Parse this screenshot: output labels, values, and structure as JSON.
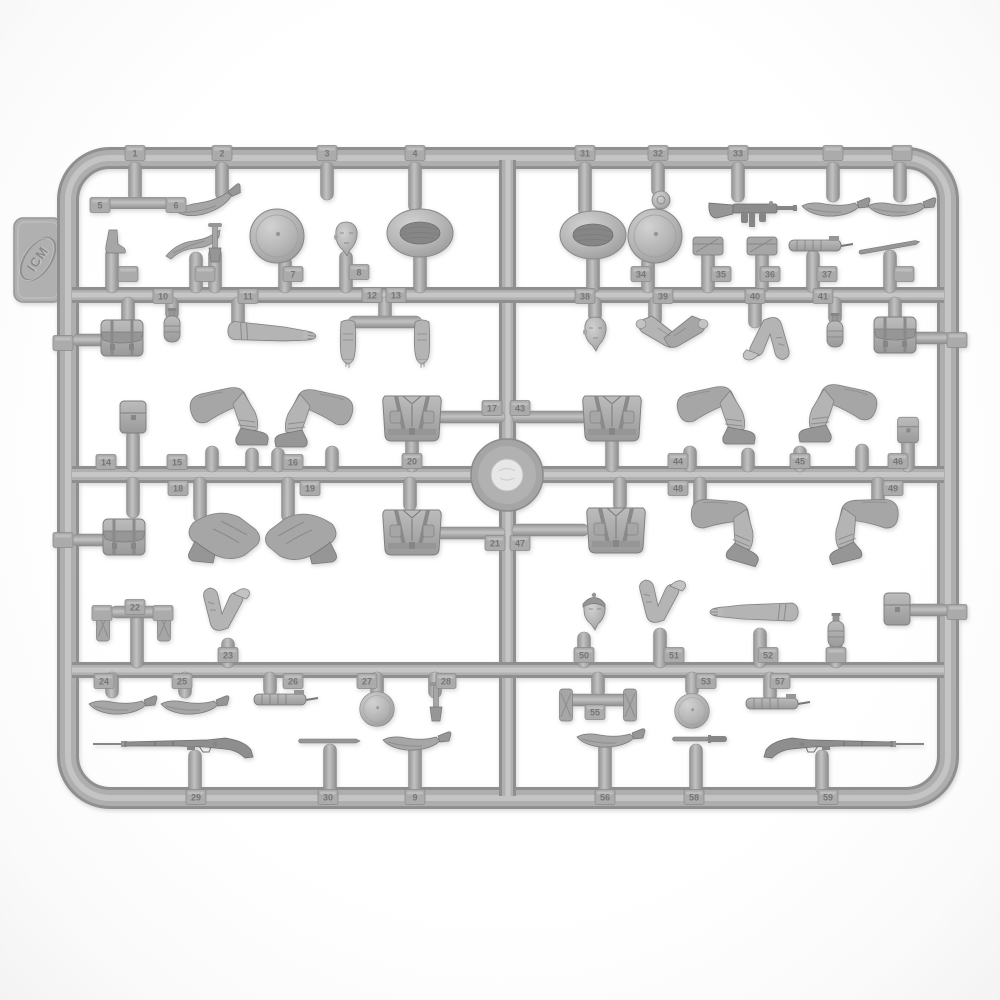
{
  "meta": {
    "subject": "grey injection-molded styrene model-kit sprue (parts tree) with WWI infantry figure parts photographed on white background",
    "background_color": "#fdfdfd"
  },
  "sprue": {
    "logo_text": "ICM",
    "colors": {
      "plastic_base": "#b0b0b0",
      "plastic_shadow": "#8e8e8e",
      "plastic_highlight": "#c8c8c8",
      "weapon_grey": "#8d8d8d",
      "boss_inner": "#e7e7e7"
    },
    "center_boss": {
      "x": 507,
      "y": 475
    },
    "parts": [
      {
        "s": "hbar",
        "x": 138,
        "y": 203
      },
      {
        "s": "kukri",
        "x": 208,
        "y": 200,
        "r": -18
      },
      {
        "s": "boot",
        "x": 112,
        "y": 242
      },
      {
        "s": "sidecap",
        "x": 193,
        "y": 247
      },
      {
        "s": "etool",
        "x": 215,
        "y": 242
      },
      {
        "s": "helmet",
        "x": 277,
        "y": 236
      },
      {
        "s": "head",
        "x": 346,
        "y": 237
      },
      {
        "s": "pilotka",
        "x": 420,
        "y": 233
      },
      {
        "s": "backpack",
        "x": 122,
        "y": 338
      },
      {
        "s": "canteen",
        "x": 172,
        "y": 328
      },
      {
        "s": "armstraight",
        "x": 270,
        "y": 333,
        "r": 4
      },
      {
        "s": "hbar",
        "x": 385,
        "y": 322
      },
      {
        "s": "armdown",
        "x": 348,
        "y": 342
      },
      {
        "s": "armdown",
        "x": 422,
        "y": 342,
        "fx": 1
      },
      {
        "s": "pouchsq",
        "x": 133,
        "y": 417
      },
      {
        "s": "legbent",
        "x": 235,
        "y": 414
      },
      {
        "s": "legbent",
        "x": 308,
        "y": 416,
        "fx": 1
      },
      {
        "s": "torso",
        "x": 412,
        "y": 417
      },
      {
        "s": "backpack",
        "x": 124,
        "y": 537
      },
      {
        "s": "legslow",
        "x": 225,
        "y": 537
      },
      {
        "s": "legslow",
        "x": 300,
        "y": 538,
        "fx": 1
      },
      {
        "s": "torso",
        "x": 412,
        "y": 531
      },
      {
        "s": "flat",
        "x": 103,
        "y": 625
      },
      {
        "s": "flat",
        "x": 164,
        "y": 625
      },
      {
        "s": "armbent",
        "x": 224,
        "y": 616
      },
      {
        "s": "kukri",
        "x": 122,
        "y": 702
      },
      {
        "s": "kukri",
        "x": 194,
        "y": 702
      },
      {
        "s": "mgpart",
        "x": 280,
        "y": 700
      },
      {
        "s": "helmet",
        "x": 377,
        "y": 709,
        "sc": 0.64
      },
      {
        "s": "etool",
        "x": 436,
        "y": 701
      },
      {
        "s": "rifle",
        "x": 185,
        "y": 744
      },
      {
        "s": "stick",
        "x": 330,
        "y": 741
      },
      {
        "s": "kukri",
        "x": 416,
        "y": 738
      },
      {
        "s": "pilotka",
        "x": 593,
        "y": 235
      },
      {
        "s": "disc",
        "x": 661,
        "y": 200
      },
      {
        "s": "helmet",
        "x": 655,
        "y": 236
      },
      {
        "s": "smg",
        "x": 745,
        "y": 210
      },
      {
        "s": "pouchflat",
        "x": 708,
        "y": 246
      },
      {
        "s": "pouchflat",
        "x": 762,
        "y": 246
      },
      {
        "s": "mgpart",
        "x": 815,
        "y": 246
      },
      {
        "s": "stick",
        "x": 890,
        "y": 247,
        "r": -10
      },
      {
        "s": "kukri",
        "x": 835,
        "y": 204
      },
      {
        "s": "kukri",
        "x": 901,
        "y": 204
      },
      {
        "s": "head",
        "x": 595,
        "y": 332
      },
      {
        "s": "armspair",
        "x": 672,
        "y": 330
      },
      {
        "s": "armbent",
        "x": 768,
        "y": 332,
        "r": 178
      },
      {
        "s": "canteen",
        "x": 835,
        "y": 333
      },
      {
        "s": "backpack",
        "x": 895,
        "y": 335
      },
      {
        "s": "torso",
        "x": 612,
        "y": 417
      },
      {
        "s": "legbent",
        "x": 722,
        "y": 413
      },
      {
        "s": "legbent",
        "x": 832,
        "y": 411,
        "fx": 1
      },
      {
        "s": "pouchsq",
        "x": 908,
        "y": 430,
        "sc": 0.8
      },
      {
        "s": "torso",
        "x": 616,
        "y": 529
      },
      {
        "s": "legbent",
        "x": 733,
        "y": 528,
        "r": 16
      },
      {
        "s": "legbent",
        "x": 856,
        "y": 527,
        "fx": 1,
        "r": -14
      },
      {
        "s": "headcap",
        "x": 594,
        "y": 611
      },
      {
        "s": "armbent",
        "x": 660,
        "y": 608
      },
      {
        "s": "armstraight",
        "x": 756,
        "y": 612,
        "fx": 1
      },
      {
        "s": "canteen",
        "x": 836,
        "y": 633
      },
      {
        "s": "pouchsq",
        "x": 897,
        "y": 609
      },
      {
        "s": "flat",
        "x": 566,
        "y": 705
      },
      {
        "s": "flat",
        "x": 630,
        "y": 705
      },
      {
        "s": "helmet",
        "x": 692,
        "y": 711,
        "sc": 0.64
      },
      {
        "s": "mgpart",
        "x": 772,
        "y": 704
      },
      {
        "s": "kukri",
        "x": 610,
        "y": 735
      },
      {
        "s": "bayonet",
        "x": 700,
        "y": 739
      },
      {
        "s": "rifle",
        "x": 832,
        "y": 744,
        "fx": 1
      }
    ],
    "stems": [
      [
        135,
        166,
        198
      ],
      [
        222,
        166,
        196
      ],
      [
        327,
        166,
        196
      ],
      [
        415,
        166,
        208
      ],
      [
        112,
        252,
        289
      ],
      [
        196,
        256,
        289
      ],
      [
        215,
        252,
        289
      ],
      [
        285,
        260,
        289
      ],
      [
        346,
        255,
        289
      ],
      [
        420,
        255,
        289
      ],
      [
        128,
        301,
        322
      ],
      [
        172,
        301,
        316
      ],
      [
        238,
        301,
        324
      ],
      [
        385,
        301,
        320
      ],
      [
        133,
        434,
        468
      ],
      [
        212,
        450,
        468
      ],
      [
        252,
        452,
        468
      ],
      [
        278,
        452,
        468
      ],
      [
        332,
        450,
        468
      ],
      [
        412,
        438,
        468
      ],
      [
        133,
        481,
        514
      ],
      [
        200,
        481,
        518
      ],
      [
        288,
        481,
        518
      ],
      [
        410,
        481,
        507
      ],
      [
        137,
        616,
        664
      ],
      [
        228,
        642,
        664
      ],
      [
        112,
        676,
        694
      ],
      [
        185,
        676,
        694
      ],
      [
        270,
        676,
        692
      ],
      [
        377,
        676,
        694
      ],
      [
        435,
        676,
        694
      ],
      [
        195,
        754,
        790
      ],
      [
        330,
        748,
        790
      ],
      [
        415,
        746,
        790
      ],
      [
        585,
        166,
        212
      ],
      [
        658,
        166,
        192
      ],
      [
        738,
        166,
        198
      ],
      [
        833,
        166,
        198
      ],
      [
        900,
        166,
        198
      ],
      [
        593,
        258,
        289
      ],
      [
        648,
        260,
        289
      ],
      [
        708,
        254,
        289
      ],
      [
        762,
        254,
        289
      ],
      [
        813,
        254,
        289
      ],
      [
        890,
        254,
        289
      ],
      [
        595,
        301,
        318
      ],
      [
        655,
        301,
        322
      ],
      [
        755,
        301,
        324
      ],
      [
        835,
        301,
        320
      ],
      [
        895,
        301,
        318
      ],
      [
        612,
        438,
        468
      ],
      [
        690,
        450,
        468
      ],
      [
        748,
        452,
        468
      ],
      [
        800,
        450,
        468
      ],
      [
        862,
        448,
        468
      ],
      [
        908,
        441,
        468
      ],
      [
        620,
        481,
        507
      ],
      [
        700,
        481,
        512
      ],
      [
        878,
        481,
        512
      ],
      [
        584,
        636,
        664
      ],
      [
        660,
        632,
        664
      ],
      [
        760,
        632,
        664
      ],
      [
        836,
        646,
        664
      ],
      [
        598,
        676,
        694
      ],
      [
        692,
        676,
        692
      ],
      [
        770,
        676,
        698
      ],
      [
        605,
        744,
        790
      ],
      [
        696,
        748,
        790
      ],
      [
        822,
        754,
        790
      ]
    ],
    "hstems": [
      [
        76,
        104,
        340
      ],
      [
        76,
        108,
        540
      ],
      [
        352,
        418,
        322
      ],
      [
        436,
        501,
        417
      ],
      [
        436,
        501,
        533
      ],
      [
        114,
        162,
        612
      ],
      [
        516,
        585,
        417
      ],
      [
        516,
        585,
        530
      ],
      [
        908,
        946,
        338
      ],
      [
        910,
        946,
        610
      ],
      [
        570,
        628,
        700
      ]
    ],
    "tabs": [
      [
        "1",
        135,
        153
      ],
      [
        "2",
        222,
        153
      ],
      [
        "3",
        327,
        153
      ],
      [
        "4",
        415,
        153
      ],
      [
        "5",
        100,
        205
      ],
      [
        "6",
        176,
        205
      ],
      [
        "7",
        293,
        274
      ],
      [
        "8",
        359,
        272
      ],
      [
        "",
        128,
        274
      ],
      [
        "",
        205,
        274
      ],
      [
        "",
        63,
        343
      ],
      [
        "10",
        163,
        296
      ],
      [
        "11",
        248,
        296
      ],
      [
        "12",
        372,
        295
      ],
      [
        "13",
        396,
        295
      ],
      [
        "14",
        106,
        462
      ],
      [
        "15",
        177,
        462
      ],
      [
        "16",
        293,
        462
      ],
      [
        "17",
        492,
        408
      ],
      [
        "20",
        412,
        461
      ],
      [
        "18",
        178,
        488
      ],
      [
        "19",
        310,
        488
      ],
      [
        "",
        63,
        540
      ],
      [
        "21",
        495,
        543
      ],
      [
        "22",
        135,
        607
      ],
      [
        "23",
        228,
        655
      ],
      [
        "",
        102,
        613
      ],
      [
        "",
        163,
        613
      ],
      [
        "24",
        104,
        681
      ],
      [
        "25",
        182,
        681
      ],
      [
        "26",
        293,
        681
      ],
      [
        "27",
        367,
        681
      ],
      [
        "28",
        446,
        681
      ],
      [
        "29",
        196,
        797
      ],
      [
        "30",
        328,
        797
      ],
      [
        "9",
        415,
        797
      ],
      [
        "31",
        585,
        153
      ],
      [
        "32",
        658,
        153
      ],
      [
        "33",
        738,
        153
      ],
      [
        "",
        833,
        153
      ],
      [
        "",
        902,
        153
      ],
      [
        "34",
        641,
        274
      ],
      [
        "35",
        721,
        274
      ],
      [
        "36",
        770,
        274
      ],
      [
        "37",
        827,
        274
      ],
      [
        "",
        904,
        274
      ],
      [
        "38",
        585,
        296
      ],
      [
        "39",
        663,
        296
      ],
      [
        "40",
        755,
        296
      ],
      [
        "41",
        823,
        296
      ],
      [
        "",
        957,
        340
      ],
      [
        "43",
        520,
        408
      ],
      [
        "44",
        678,
        461
      ],
      [
        "45",
        800,
        461
      ],
      [
        "46",
        898,
        461
      ],
      [
        "47",
        520,
        543
      ],
      [
        "48",
        678,
        488
      ],
      [
        "49",
        893,
        488
      ],
      [
        "50",
        584,
        655
      ],
      [
        "51",
        674,
        655
      ],
      [
        "52",
        768,
        655
      ],
      [
        "",
        836,
        655
      ],
      [
        "",
        957,
        612
      ],
      [
        "53",
        706,
        681
      ],
      [
        "55",
        595,
        712
      ],
      [
        "57",
        780,
        681
      ],
      [
        "56",
        605,
        797
      ],
      [
        "58",
        694,
        797
      ],
      [
        "59",
        828,
        797
      ]
    ]
  }
}
